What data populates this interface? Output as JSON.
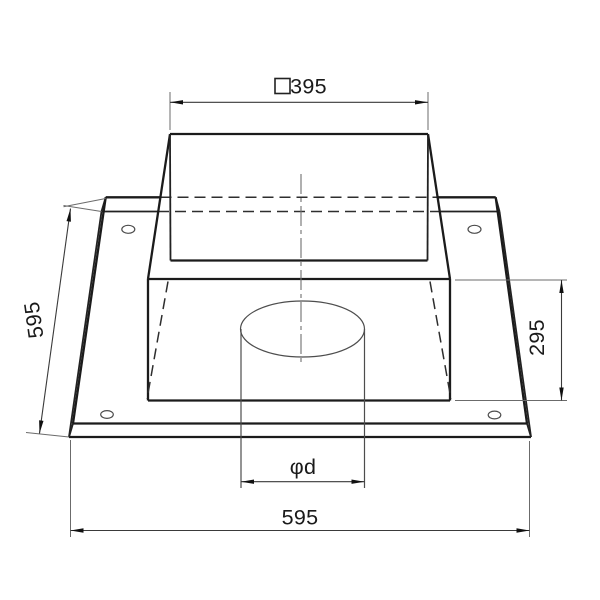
{
  "meta": {
    "type": "technical-drawing",
    "subject": "square base plate with tapered collar and round hole",
    "background": "#ffffff"
  },
  "colors": {
    "outline": "#1b1b1b",
    "hidden_edge": "#2e2e2e",
    "thin_line": "#4d4d4d",
    "dimension_line": "#3a3a3a",
    "centerline": "#707070",
    "text": "#1a1a1a"
  },
  "dimensions": {
    "top_width": {
      "label": "□395",
      "symbol": "□",
      "value": "395"
    },
    "left_depth": {
      "label": "595",
      "value": "595"
    },
    "right_height": {
      "label": "295",
      "value": "295"
    },
    "hole_diameter": {
      "label": "φd",
      "value": "φd"
    },
    "bottom_width": {
      "label": "595",
      "value": "595"
    }
  }
}
